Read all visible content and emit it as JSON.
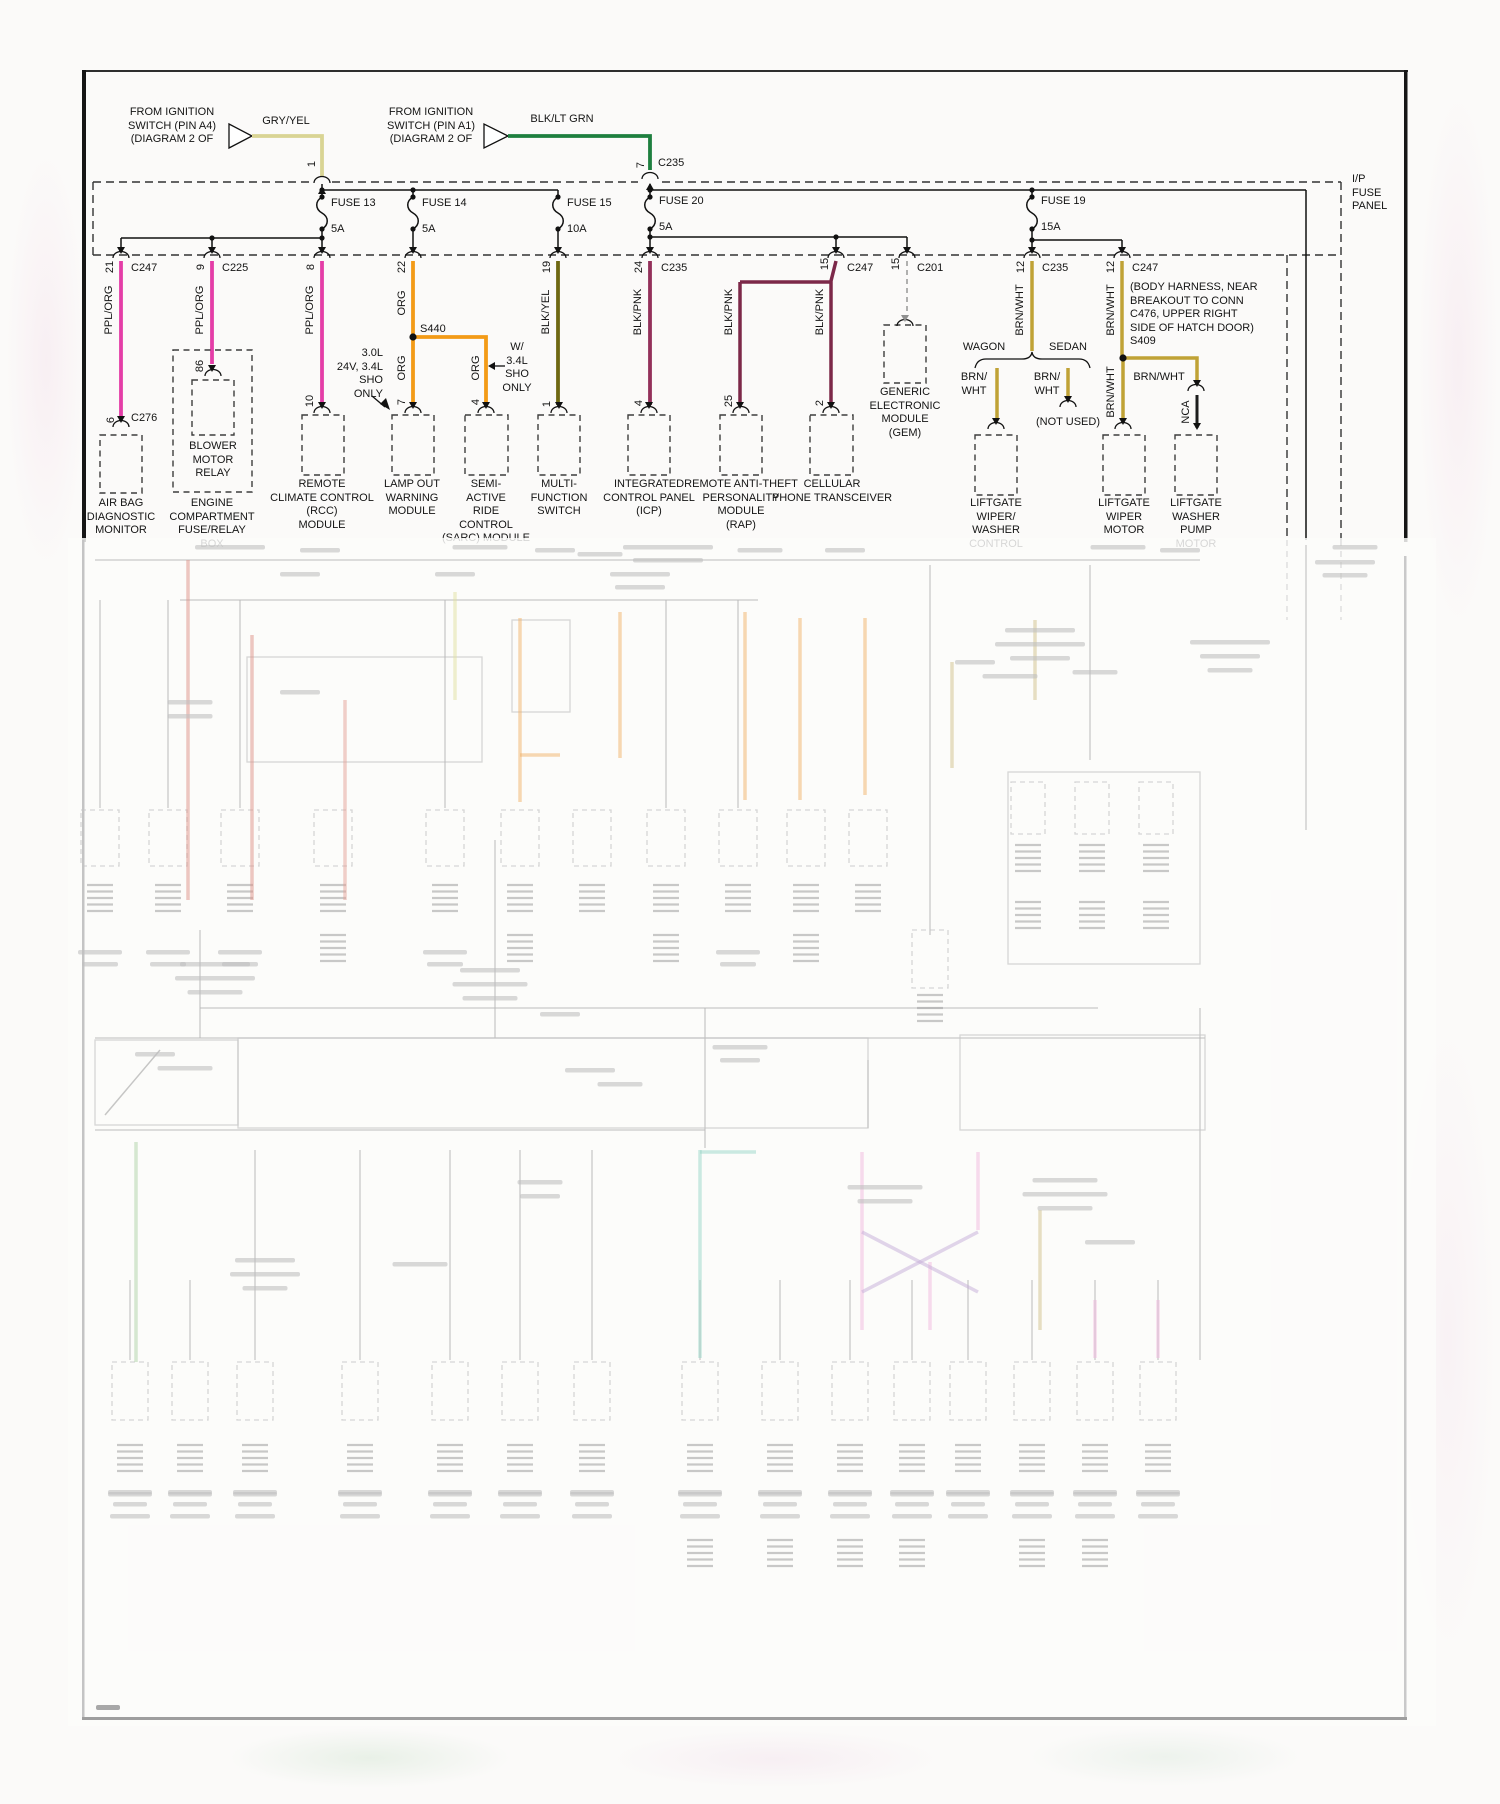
{
  "colors": {
    "ppl_org": "#e43da7",
    "org": "#f39b17",
    "gry_yel": "#d9d494",
    "blk_lt_grn": "#1e7f3f",
    "blk_yel": "#6e6812",
    "blk_pnk": "#8f2e55",
    "brn_wht": "#c0a236",
    "nca": "#1d1d1d"
  },
  "sources": {
    "g": {
      "lines": [
        "FROM IGNITION",
        "SWITCH (PIN A4)",
        "(DIAGRAM 2 OF"
      ],
      "tag": "G",
      "wire": "GRY/YEL",
      "pin": "1"
    },
    "h": {
      "lines": [
        "FROM IGNITION",
        "SWITCH (PIN A1)",
        "(DIAGRAM 2 OF"
      ],
      "tag": "H",
      "wire": "BLK/LT GRN",
      "pin": "7",
      "conn": "C235"
    }
  },
  "panel": {
    "label_lines": [
      "I/P",
      "FUSE",
      "PANEL"
    ]
  },
  "fuses": [
    {
      "name": "FUSE 13",
      "amp": "5A"
    },
    {
      "name": "FUSE 14",
      "amp": "5A"
    },
    {
      "name": "FUSE 15",
      "amp": "10A"
    },
    {
      "name": "FUSE 20",
      "amp": "5A"
    },
    {
      "name": "FUSE 19",
      "amp": "15A"
    }
  ],
  "drops": {
    "d1": {
      "pin": "21",
      "conn": "C247",
      "wire": "PPL/ORG",
      "pin_b": "6",
      "conn_b": "C276"
    },
    "d2": {
      "pin": "9",
      "conn": "C225",
      "wire": "PPL/ORG",
      "pin_b": "86"
    },
    "d3": {
      "pin": "8",
      "wire": "PPL/ORG",
      "pin_b": "10"
    },
    "d4": {
      "pin": "22",
      "wire": "ORG",
      "wire2": "ORG",
      "wire3": "ORG",
      "splice": "S440",
      "pin_b": "7",
      "pin_b2": "4",
      "note_a_lines": [
        "3.0L",
        "24V, 3.4L",
        "SHO",
        "ONLY"
      ],
      "note_b_lines": [
        "W/",
        "3.4L",
        "SHO",
        "ONLY"
      ]
    },
    "d5": {
      "pin": "19",
      "wire": "BLK/YEL",
      "pin_b": "1"
    },
    "d6": {
      "pin": "24",
      "conn": "C235",
      "wire": "BLK/PNK",
      "pin_b": "4"
    },
    "d7": {
      "pin": "15",
      "conn": "C247",
      "wire": "BLK/PNK",
      "wire2": "BLK/PNK",
      "pin_b": "25",
      "pin_b2": "2"
    },
    "d8": {
      "pin": "15",
      "conn": "C201"
    },
    "d9": {
      "pin": "12",
      "conn": "C235",
      "wire": "BRN/WHT",
      "branch_left": "WAGON",
      "branch_right": "SEDAN",
      "wire_l_lines": [
        "BRN/",
        "WHT"
      ],
      "wire_r_lines": [
        "BRN/",
        "WHT"
      ],
      "not_used": "(NOT USED)"
    },
    "d10": {
      "pin": "12",
      "conn": "C247",
      "wire": "BRN/WHT",
      "wire2": "BRN/WHT",
      "wire3": "NCA",
      "note_lines": [
        "(BODY HARNESS, NEAR",
        "BREAKOUT TO CONN",
        "C476, UPPER RIGHT",
        "SIDE OF HATCH DOOR)",
        "S409"
      ]
    }
  },
  "components": {
    "air_bag": {
      "lines": [
        "AIR BAG",
        "DIAGNOSTIC",
        "MONITOR"
      ]
    },
    "engine_box": {
      "lines": [
        "ENGINE",
        "COMPARTMENT",
        "FUSE/RELAY",
        "BOX"
      ]
    },
    "blower": {
      "lines": [
        "BLOWER",
        "MOTOR",
        "RELAY"
      ]
    },
    "rcc": {
      "lines": [
        "REMOTE",
        "CLIMATE CONTROL",
        "(RCC)",
        "MODULE"
      ]
    },
    "lamp_out": {
      "lines": [
        "LAMP OUT",
        "WARNING",
        "MODULE"
      ]
    },
    "sarc": {
      "lines": [
        "SEMI-",
        "ACTIVE",
        "RIDE",
        "CONTROL",
        "(SARC) MODULE"
      ]
    },
    "multi": {
      "lines": [
        "MULTI-",
        "FUNCTION",
        "SWITCH"
      ]
    },
    "icp": {
      "lines": [
        "INTEGRATED",
        "CONTROL PANEL",
        "(ICP)"
      ]
    },
    "rap": {
      "lines": [
        "REMOTE ANTI-THEFT",
        "PERSONALITY",
        "MODULE",
        "(RAP)"
      ]
    },
    "cellular": {
      "lines": [
        "CELLULAR",
        "PHONE TRANSCEIVER"
      ]
    },
    "gem": {
      "lines": [
        "GENERIC",
        "ELECTRONIC",
        "MODULE",
        "(GEM)"
      ]
    },
    "liftgate_ww": {
      "lines": [
        "LIFTGATE",
        "WIPER/",
        "WASHER",
        "CONTROL"
      ]
    },
    "liftgate_wm": {
      "lines": [
        "LIFTGATE",
        "WIPER",
        "MOTOR"
      ]
    },
    "liftgate_wp": {
      "lines": [
        "LIFTGATE",
        "WASHER",
        "PUMP",
        "MOTOR"
      ]
    }
  }
}
